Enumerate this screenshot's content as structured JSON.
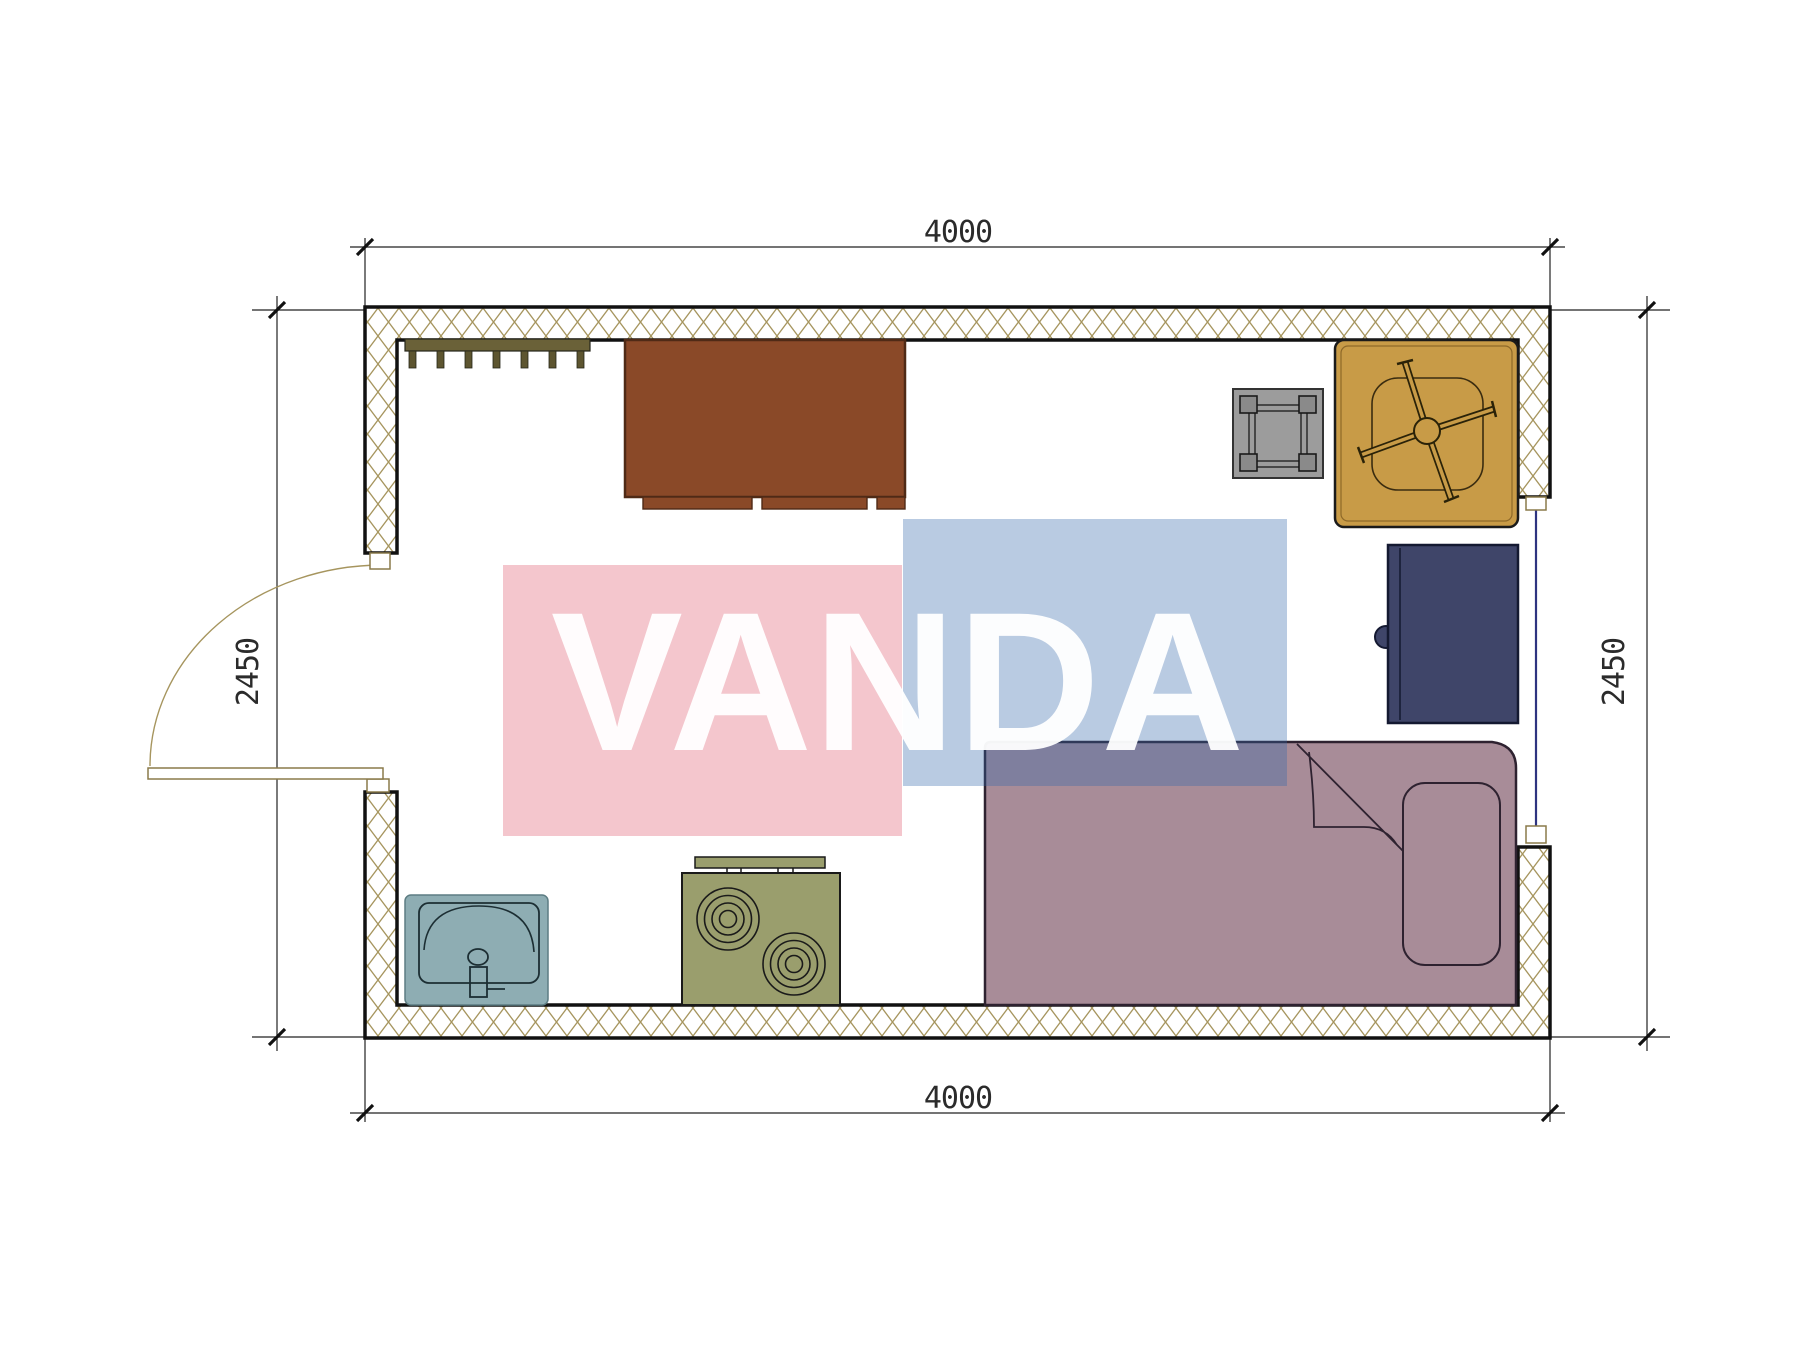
{
  "plan": {
    "dimension_labels": {
      "top": "4000",
      "bottom": "4000",
      "left": "2450",
      "right": "2450"
    },
    "watermark": {
      "text": "VANDA",
      "pink_color": "rgba(223, 88, 109, 0.34)",
      "blue_color": "rgba(50, 103, 171, 0.34)",
      "text_color": "rgba(255, 255, 255, 0.95)"
    },
    "colors": {
      "wall_hatch": "#a6955e",
      "wall_outline": "#111111",
      "coat_rack": "#6a6138",
      "coat_rack_peg": "#5d5530",
      "wardrobe": "#8a4928",
      "stool": "#9c9c9c",
      "stool_post": "#8a8a8a",
      "table": "#c89b47",
      "fridge": "#3f4569",
      "bed": "#a88c98",
      "sink": "#8eadb3",
      "stove": "#9a9e6d",
      "window_glass": "#2e3480",
      "door_frame": "#8a7a4a",
      "dimension_lines": "#222222"
    },
    "furniture": [
      {
        "id": "coat-rack"
      },
      {
        "id": "wardrobe"
      },
      {
        "id": "stool"
      },
      {
        "id": "table-with-office-chair"
      },
      {
        "id": "refrigerator"
      },
      {
        "id": "bed-with-pillow"
      },
      {
        "id": "sink"
      },
      {
        "id": "cooktop-stove"
      }
    ],
    "openings": [
      {
        "id": "door-left",
        "type": "swing-door"
      },
      {
        "id": "window-right",
        "type": "window"
      }
    ]
  }
}
